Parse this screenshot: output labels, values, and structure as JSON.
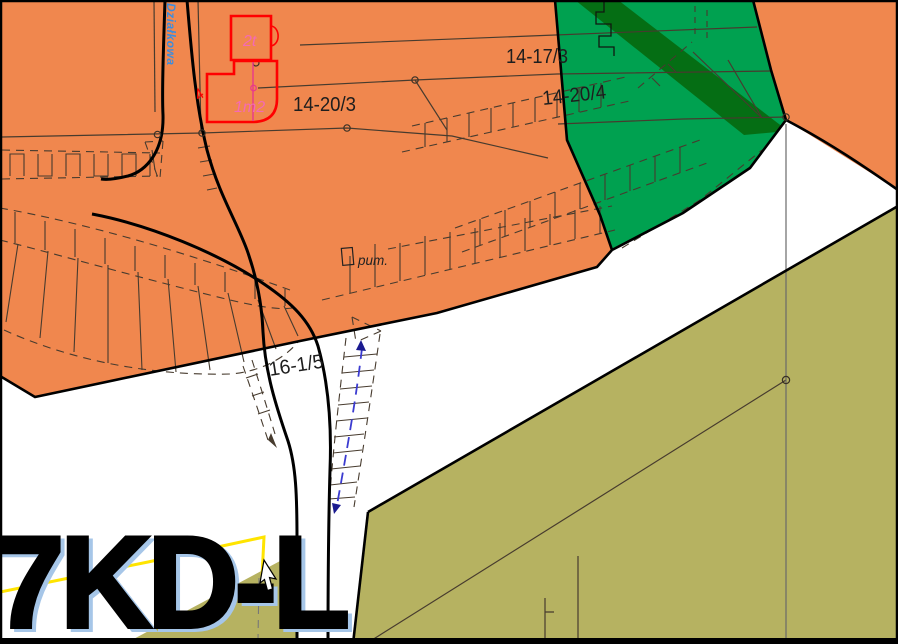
{
  "map": {
    "parcels": {
      "p1": "14-17/3",
      "p2": "14-20/3",
      "p3": "14-20/4",
      "p4": "16-1/5"
    },
    "annotations": {
      "pump": "pum.",
      "building_a": "2t",
      "building_b": "1m2",
      "building_mark": "4"
    },
    "street": {
      "name": "Działkowa"
    },
    "zone_label": {
      "text": "7KD-L"
    },
    "colors": {
      "residential": "#F0874E",
      "forest": "#00A150",
      "forest_dark_band": "#056E14",
      "agricultural": "#B6B261",
      "background": "#FFFFFF",
      "building_outline": "#FF0000",
      "building_label_pink": "#F46AB4",
      "street_label_blue": "#3C8DDE",
      "utility_blue": "#3B3BD0",
      "boundary_yellow": "#FFE400",
      "line_dark": "#473B2E"
    }
  }
}
